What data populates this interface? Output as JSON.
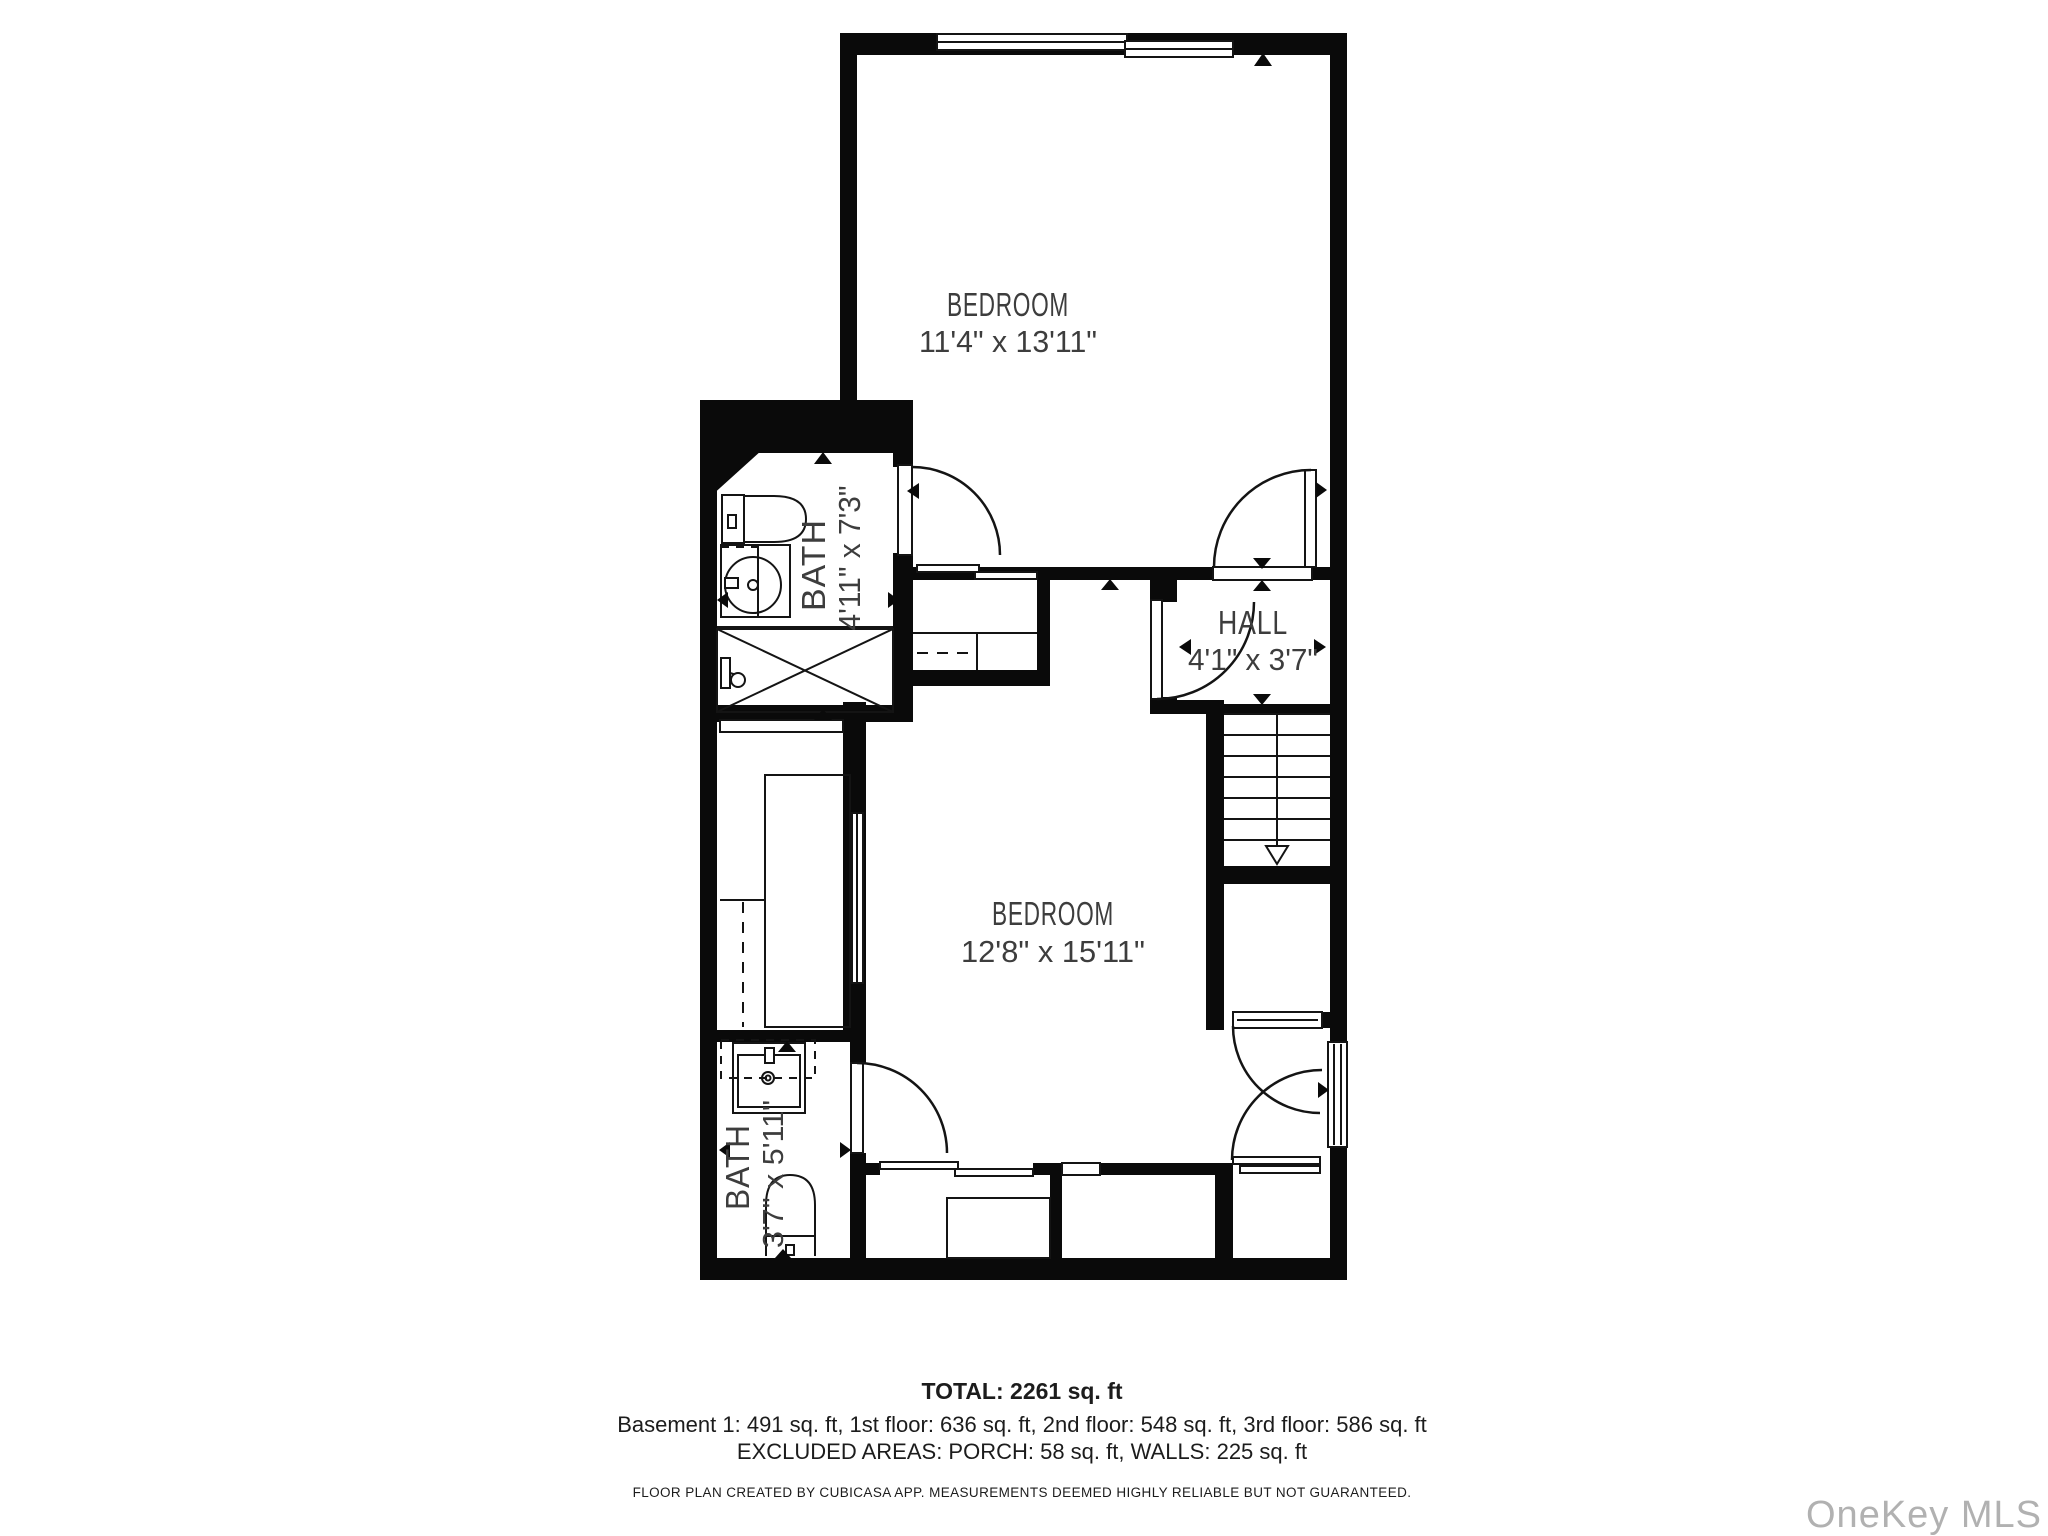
{
  "rooms": {
    "bedroom_top": {
      "name": "BEDROOM",
      "dims": "11'4\" x 13'11\""
    },
    "bath_top": {
      "name": "BATH",
      "dims": "4'11\" x 7'3\""
    },
    "hall": {
      "name": "HALL",
      "dims": "4'1\" x 3'7\""
    },
    "bedroom_mid": {
      "name": "BEDROOM",
      "dims": "12'8\" x 15'11\""
    },
    "bath_bottom": {
      "name": "BATH",
      "dims": "3'7\" x 5'11\""
    }
  },
  "summary": {
    "total": "TOTAL: 2261 sq. ft",
    "floors": "Basement 1: 491 sq. ft, 1st floor: 636 sq. ft, 2nd floor: 548 sq. ft, 3rd floor: 586 sq. ft",
    "excluded": "EXCLUDED AREAS: PORCH: 58 sq. ft, WALLS: 225 sq. ft"
  },
  "disclaimer": "FLOOR PLAN CREATED BY CUBICASA APP. MEASUREMENTS DEEMED HIGHLY RELIABLE BUT NOT GUARANTEED.",
  "watermark": "OneKey MLS",
  "fixtures": [
    "toilet",
    "sink",
    "shower",
    "wardrobe",
    "staircase-down",
    "door",
    "window",
    "sliding-door"
  ],
  "colors": {
    "wall": "#0a0a0a",
    "room_text": "#3d3d3d",
    "summary_text": "#1c1c1c",
    "watermark": "#b1b1b1",
    "background": "#ffffff"
  }
}
